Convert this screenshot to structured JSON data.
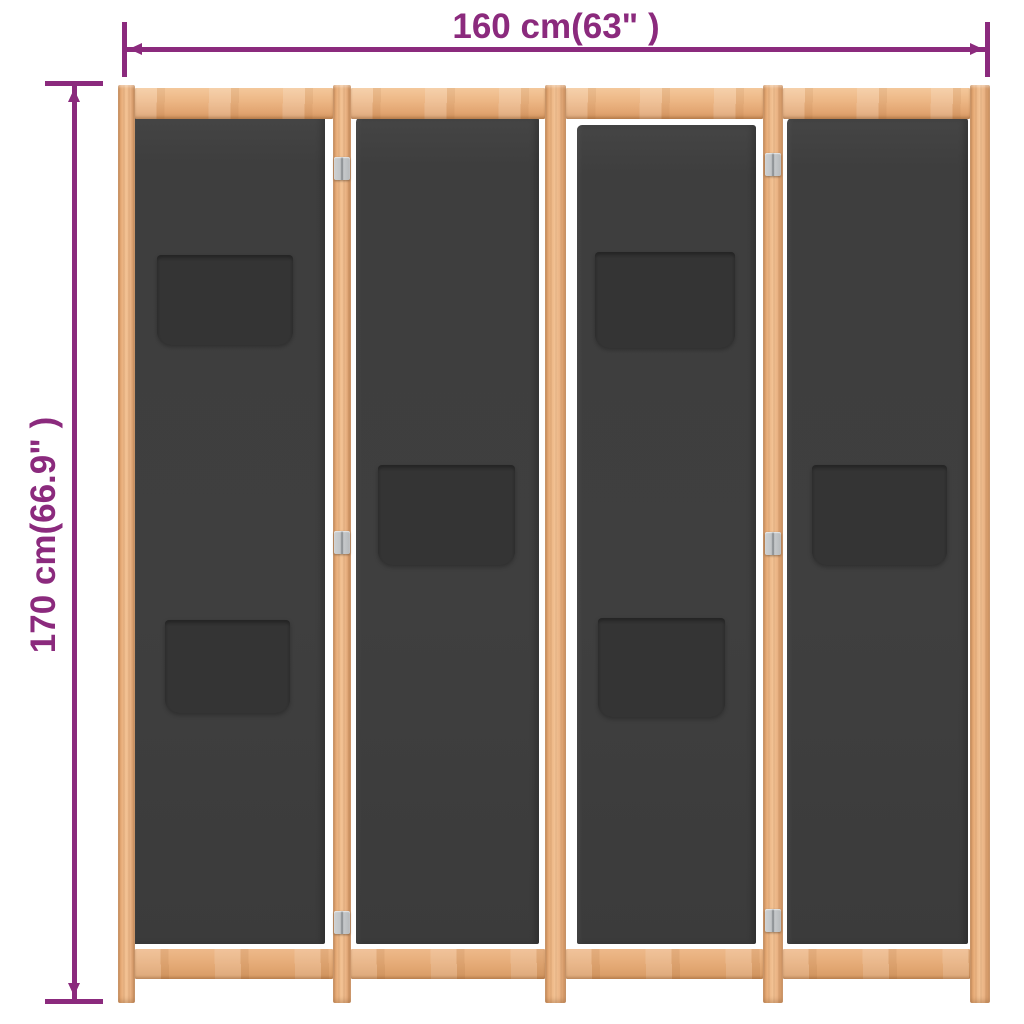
{
  "annotations": {
    "width_label": "160 cm(63\" )",
    "height_label": "170 cm(66.9\" )"
  },
  "colors": {
    "annotation_purple": "#8B2A7D",
    "wood_light": "#F3C79A",
    "wood_base": "#EAB27F",
    "wood_dark": "#D6975F",
    "fabric_gray": "#3F3F3F",
    "pocket_gray": "#343434",
    "hinge_metal": "#C3C6C8",
    "background": "#FFFFFF"
  },
  "structure": {
    "panel_count": 4,
    "pocket_count": 6,
    "hinge_count": 6
  }
}
